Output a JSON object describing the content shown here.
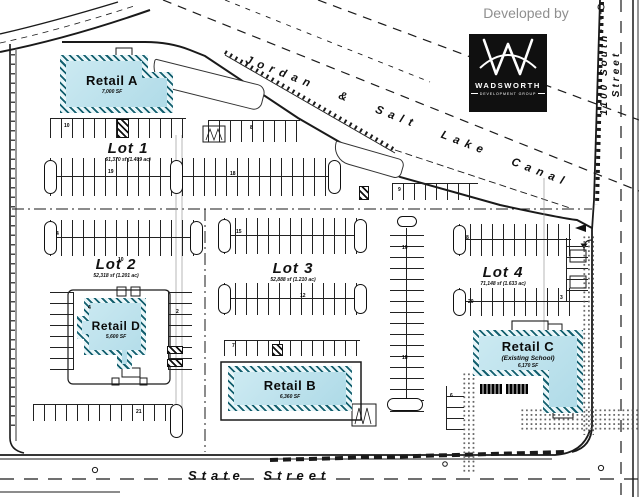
{
  "header": {
    "developed_by": "Developed by"
  },
  "logo": {
    "monogram": "W",
    "name": "WADSWORTH",
    "subtitle": "DEVELOPMENT GROUP"
  },
  "streets": {
    "canal": "Jordan & Salt Lake Canal",
    "south": "State Street",
    "east_line1": "1100 South",
    "east_line2": "Street"
  },
  "buildings": {
    "a": {
      "name": "Retail A",
      "size": "7,000 SF"
    },
    "b": {
      "name": "Retail B",
      "size": "6,360 SF"
    },
    "c": {
      "name": "Retail C",
      "note": "(Existing School)",
      "size": "6,170 SF"
    },
    "d": {
      "name": "Retail D",
      "size": "5,600 SF"
    }
  },
  "lots": [
    {
      "name": "Lot 1",
      "area": "61,370 sf (1.409 ac)"
    },
    {
      "name": "Lot 2",
      "area": "52,318 sf (1.201 ac)"
    },
    {
      "name": "Lot 3",
      "area": "52,888 sf (1.210 ac)"
    },
    {
      "name": "Lot 4",
      "area": "71,148 sf (1.633 ac)"
    }
  ],
  "stall_counts": [
    {
      "v": "10",
      "x": 64,
      "y": 124
    },
    {
      "v": "8",
      "x": 250,
      "y": 126
    },
    {
      "v": "19",
      "x": 108,
      "y": 170
    },
    {
      "v": "18",
      "x": 230,
      "y": 172
    },
    {
      "v": "9",
      "x": 398,
      "y": 188
    },
    {
      "v": "4",
      "x": 56,
      "y": 232
    },
    {
      "v": "15",
      "x": 236,
      "y": 230
    },
    {
      "v": "8",
      "x": 466,
      "y": 236
    },
    {
      "v": "10",
      "x": 118,
      "y": 258
    },
    {
      "v": "12",
      "x": 300,
      "y": 294
    },
    {
      "v": "20",
      "x": 468,
      "y": 300
    },
    {
      "v": "3",
      "x": 560,
      "y": 296
    },
    {
      "v": "4",
      "x": 88,
      "y": 306
    },
    {
      "v": "2",
      "x": 176,
      "y": 310
    },
    {
      "v": "7",
      "x": 232,
      "y": 344
    },
    {
      "v": "21",
      "x": 136,
      "y": 410
    },
    {
      "v": "10",
      "x": 402,
      "y": 246
    },
    {
      "v": "18",
      "x": 402,
      "y": 356
    },
    {
      "v": "6",
      "x": 450,
      "y": 394
    }
  ],
  "colors": {
    "building_fill": "#b9e2ec",
    "building_hatch": "#14606f",
    "linework": "#1a1a1a",
    "logo_bg": "#101010",
    "developed_by_text": "#8f8f8f"
  }
}
